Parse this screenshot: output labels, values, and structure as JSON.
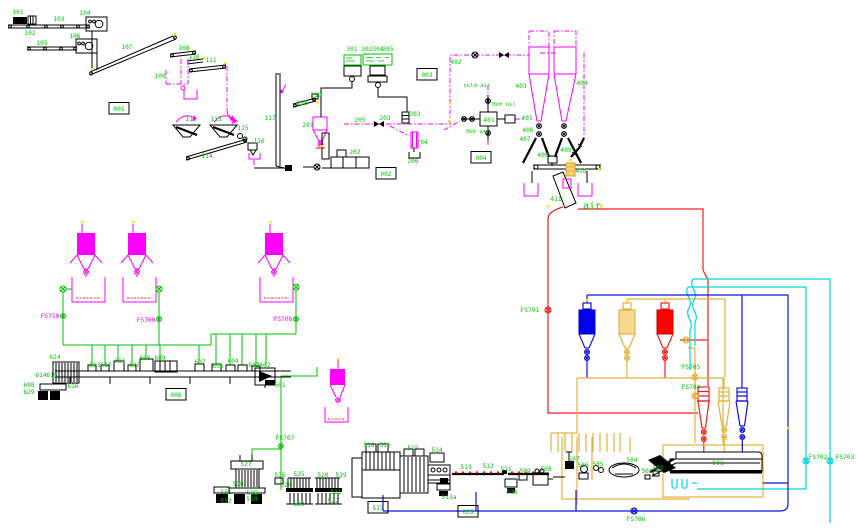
{
  "diagram": {
    "type": "process-flow-diagram",
    "colors": {
      "label_green": "#00c400",
      "pneumatic_magenta": "#ff00ff",
      "hot_red": "#f02020",
      "water_blue": "#1212dd",
      "cooling_cyan": "#00d8d8",
      "pellet_yellow": "#e4b23c",
      "equipment_black": "#000000",
      "junction_yellow": "#ffe000",
      "background": "#ffffff"
    },
    "boxed_labels": [
      {
        "t": "001",
        "x": 119,
        "y": 111
      },
      {
        "t": "002",
        "x": 386,
        "y": 176
      },
      {
        "t": "003",
        "x": 427,
        "y": 77
      },
      {
        "t": "004",
        "x": 481,
        "y": 160
      },
      {
        "t": "005",
        "x": 468,
        "y": 514
      },
      {
        "t": "006",
        "x": 176,
        "y": 397
      },
      {
        "t": "517",
        "x": 378,
        "y": 510
      }
    ],
    "labels": [
      {
        "t": "101",
        "x": 18,
        "y": 14
      },
      {
        "t": "102",
        "x": 30,
        "y": 35
      },
      {
        "t": "103",
        "x": 59,
        "y": 21
      },
      {
        "t": "104",
        "x": 85,
        "y": 15
      },
      {
        "t": "105",
        "x": 42,
        "y": 45
      },
      {
        "t": "106",
        "x": 75,
        "y": 38
      },
      {
        "t": "107",
        "x": 127,
        "y": 49
      },
      {
        "t": "108",
        "x": 184,
        "y": 50
      },
      {
        "t": "109",
        "x": 160,
        "y": 78
      },
      {
        "t": "110",
        "x": 194,
        "y": 59
      },
      {
        "t": "111",
        "x": 211,
        "y": 62
      },
      {
        "t": "112",
        "x": 191,
        "y": 121
      },
      {
        "t": "113",
        "x": 216,
        "y": 121
      },
      {
        "t": "114",
        "x": 207,
        "y": 158
      },
      {
        "t": "115",
        "x": 243,
        "y": 130
      },
      {
        "t": "116",
        "x": 259,
        "y": 143
      },
      {
        "t": "117",
        "x": 270,
        "y": 120
      },
      {
        "t": "118",
        "x": 302,
        "y": 105
      },
      {
        "t": "119",
        "x": 316,
        "y": 97
      },
      {
        "t": "201",
        "x": 308,
        "y": 127
      },
      {
        "t": "202",
        "x": 355,
        "y": 154
      },
      {
        "t": "203",
        "x": 385,
        "y": 120
      },
      {
        "t": "204",
        "x": 422,
        "y": 144
      },
      {
        "t": "205",
        "x": 360,
        "y": 122
      },
      {
        "t": "206",
        "x": 413,
        "y": 163
      },
      {
        "t": "301",
        "x": 352,
        "y": 51
      },
      {
        "t": "302",
        "x": 367,
        "y": 51
      },
      {
        "t": "304",
        "x": 378,
        "y": 51
      },
      {
        "t": "305",
        "x": 388,
        "y": 51
      },
      {
        "t": "303",
        "x": 415,
        "y": 116
      },
      {
        "t": "401",
        "x": 489,
        "y": 122
      },
      {
        "t": "402",
        "x": 456,
        "y": 64
      },
      {
        "t": "403",
        "x": 521,
        "y": 88
      },
      {
        "t": "404",
        "x": 582,
        "y": 85
      },
      {
        "t": "405",
        "x": 527,
        "y": 120
      },
      {
        "t": "406",
        "x": 528,
        "y": 132
      },
      {
        "t": "407",
        "x": 525,
        "y": 141
      },
      {
        "t": "408",
        "x": 543,
        "y": 157
      },
      {
        "t": "409",
        "x": 566,
        "y": 152
      },
      {
        "t": "410",
        "x": 581,
        "y": 173
      },
      {
        "t": "411",
        "x": 556,
        "y": 201
      },
      {
        "t": "cold air",
        "x": 477,
        "y": 87,
        "s": 5.6,
        "n": "label-cold-air"
      },
      {
        "t": "Hot oil",
        "x": 504,
        "y": 106,
        "s": 5.6,
        "n": "label-hot-oil"
      },
      {
        "t": "Hot air",
        "x": 478,
        "y": 133,
        "s": 5.6,
        "n": "label-hot-air"
      },
      {
        "t": "air",
        "x": 592,
        "y": 209,
        "s": 10,
        "n": "label-air"
      },
      {
        "t": "501",
        "x": 718,
        "y": 465
      },
      {
        "t": "502",
        "x": 658,
        "y": 470
      },
      {
        "t": "503",
        "x": 647,
        "y": 473
      },
      {
        "t": "504",
        "x": 632,
        "y": 462
      },
      {
        "t": "505",
        "x": 598,
        "y": 466
      },
      {
        "t": "506",
        "x": 583,
        "y": 467
      },
      {
        "t": "507",
        "x": 574,
        "y": 461
      },
      {
        "t": "508",
        "x": 546,
        "y": 471
      },
      {
        "t": "509",
        "x": 525,
        "y": 473
      },
      {
        "t": "510",
        "x": 512,
        "y": 494
      },
      {
        "t": "511",
        "x": 506,
        "y": 471
      },
      {
        "t": "512",
        "x": 488,
        "y": 468
      },
      {
        "t": "513",
        "x": 466,
        "y": 469
      },
      {
        "t": "513a",
        "x": 449,
        "y": 499
      },
      {
        "t": "514",
        "x": 437,
        "y": 452
      },
      {
        "t": "515",
        "x": 413,
        "y": 450
      },
      {
        "t": "516",
        "x": 385,
        "y": 447
      },
      {
        "t": "518",
        "x": 369,
        "y": 447
      },
      {
        "t": "519",
        "x": 341,
        "y": 477
      },
      {
        "t": "520",
        "x": 323,
        "y": 477
      },
      {
        "t": "521",
        "x": 336,
        "y": 494
      },
      {
        "t": "522",
        "x": 333,
        "y": 503
      },
      {
        "t": "523",
        "x": 299,
        "y": 506
      },
      {
        "t": "524",
        "x": 286,
        "y": 487
      },
      {
        "t": "525",
        "x": 299,
        "y": 476
      },
      {
        "t": "526",
        "x": 280,
        "y": 477
      },
      {
        "t": "527",
        "x": 246,
        "y": 466
      },
      {
        "t": "528",
        "x": 252,
        "y": 495
      },
      {
        "t": "529",
        "x": 252,
        "y": 501
      },
      {
        "t": "530",
        "x": 238,
        "y": 486
      },
      {
        "t": "531",
        "x": 226,
        "y": 494
      },
      {
        "t": "532",
        "x": 226,
        "y": 503
      },
      {
        "t": "601",
        "x": 280,
        "y": 387
      },
      {
        "t": "602",
        "x": 265,
        "y": 367
      },
      {
        "t": "603",
        "x": 254,
        "y": 367
      },
      {
        "t": "604",
        "x": 233,
        "y": 363
      },
      {
        "t": "605",
        "x": 218,
        "y": 368
      },
      {
        "t": "606",
        "x": 145,
        "y": 360
      },
      {
        "t": "607",
        "x": 200,
        "y": 364
      },
      {
        "t": "608",
        "x": 29,
        "y": 387
      },
      {
        "t": "609",
        "x": 160,
        "y": 360
      },
      {
        "t": "611",
        "x": 120,
        "y": 363
      },
      {
        "t": "614",
        "x": 41,
        "y": 377
      },
      {
        "t": "615",
        "x": 52,
        "y": 377
      },
      {
        "t": "616",
        "x": 73,
        "y": 388
      },
      {
        "t": "617",
        "x": 106,
        "y": 367
      },
      {
        "t": "618",
        "x": 135,
        "y": 367
      },
      {
        "t": "623",
        "x": 95,
        "y": 367
      },
      {
        "t": "624",
        "x": 55,
        "y": 359
      },
      {
        "t": "629",
        "x": 29,
        "y": 394
      },
      {
        "t": "FS701",
        "x": 530,
        "y": 312,
        "n": "label-fs701"
      },
      {
        "t": "FS702",
        "x": 818,
        "y": 459,
        "n": "label-fs702"
      },
      {
        "t": "FS703",
        "x": 845,
        "y": 459,
        "n": "label-fs703"
      },
      {
        "t": "FS704",
        "x": 691,
        "y": 389,
        "n": "label-fs704"
      },
      {
        "t": "FS705",
        "x": 691,
        "y": 369,
        "n": "label-fs705"
      },
      {
        "t": "FS706",
        "x": 636,
        "y": 521,
        "n": "label-fs706"
      },
      {
        "t": "FS707",
        "x": 285,
        "y": 440,
        "n": "label-fs707"
      },
      {
        "t": "FS708",
        "x": 283,
        "y": 321,
        "c": "m",
        "n": "label-fs708"
      },
      {
        "t": "FS709",
        "x": 146,
        "y": 322,
        "c": "m",
        "n": "label-fs709"
      },
      {
        "t": "FS710",
        "x": 50,
        "y": 318,
        "c": "m",
        "n": "label-fs710"
      }
    ]
  }
}
